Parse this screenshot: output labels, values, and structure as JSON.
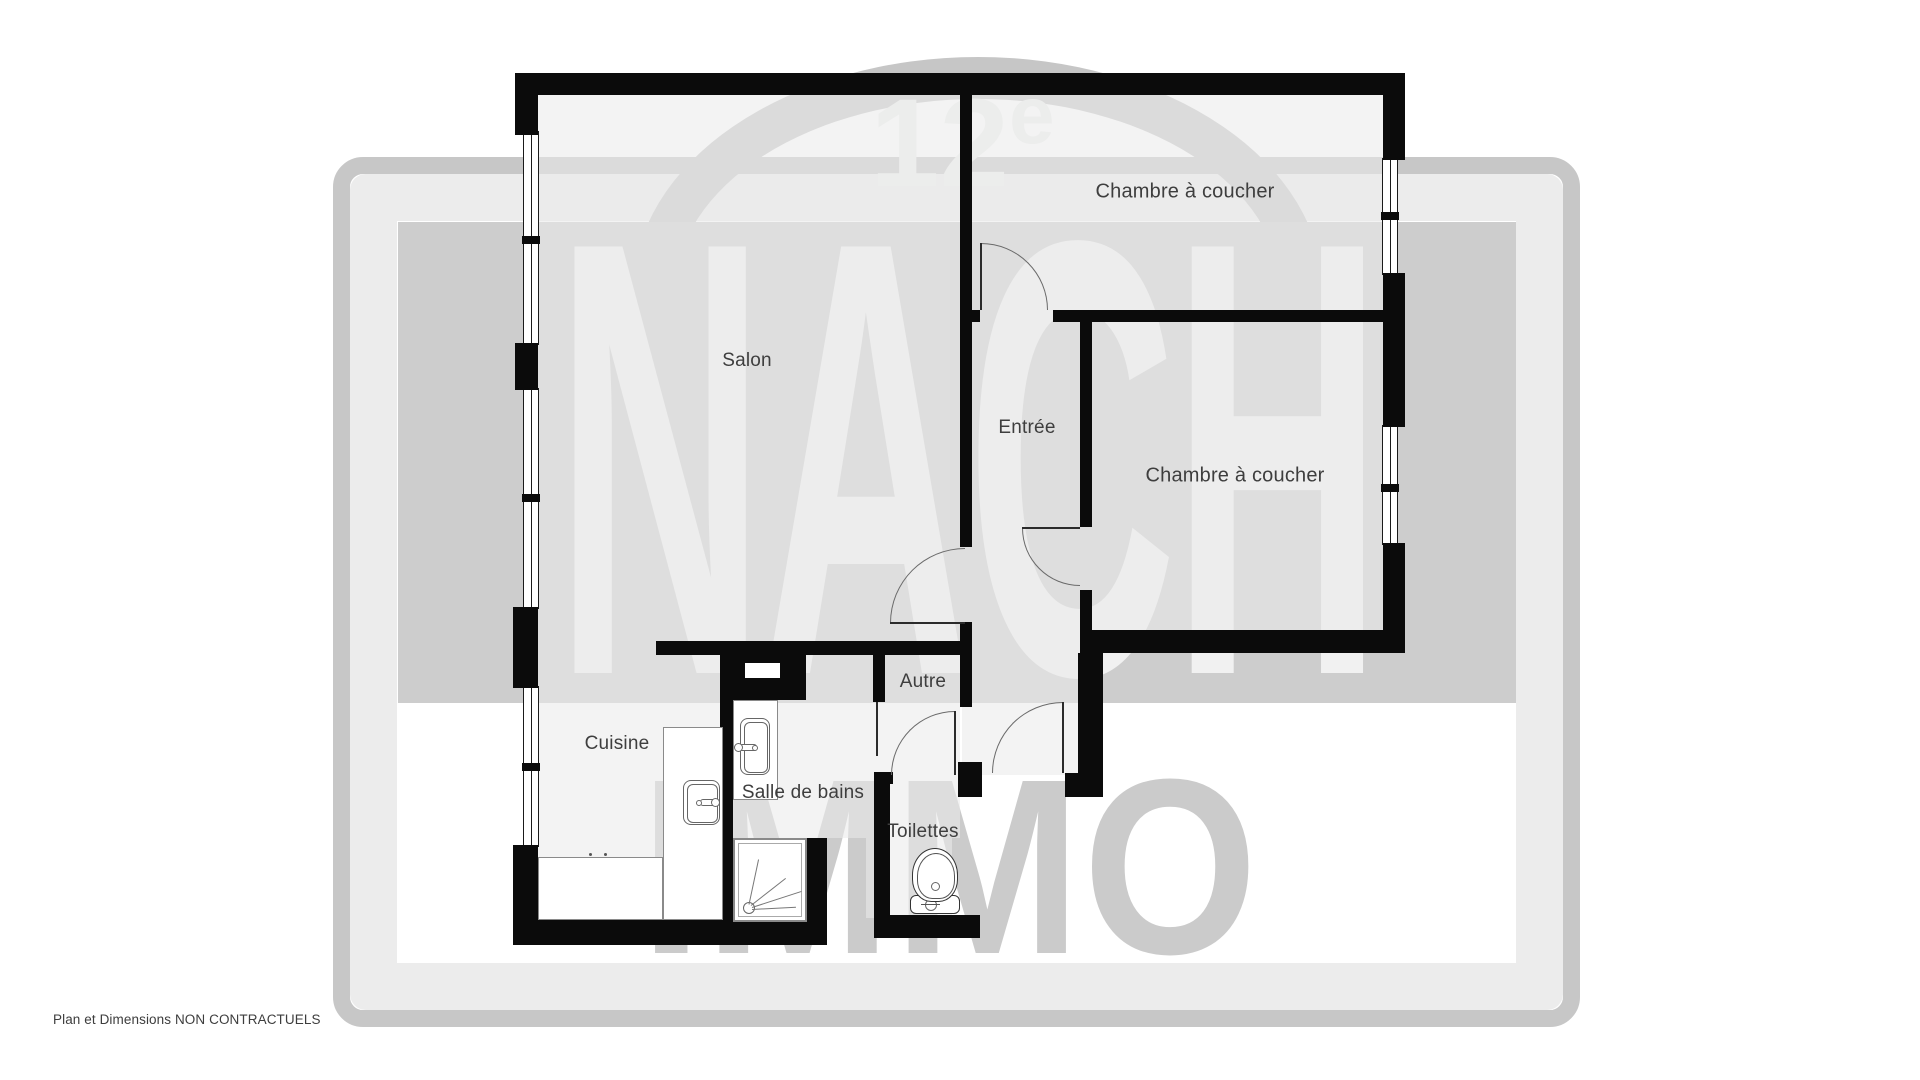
{
  "plan": {
    "rooms": [
      {
        "id": "chambre-1",
        "label": "Chambre à coucher"
      },
      {
        "id": "chambre-2",
        "label": "Chambre à coucher"
      },
      {
        "id": "salon",
        "label": "Salon"
      },
      {
        "id": "entree",
        "label": "Entrée"
      },
      {
        "id": "cuisine",
        "label": "Cuisine"
      },
      {
        "id": "salle-de-bains",
        "label": "Salle de bains"
      },
      {
        "id": "toilettes",
        "label": "Toilettes"
      },
      {
        "id": "autre",
        "label": "Autre"
      }
    ],
    "disclaimer": "Plan et Dimensions NON CONTRACTUELS"
  },
  "watermark": {
    "brand_top": "NACH",
    "brand_bottom": "IMMO",
    "arrondissement_number": "12",
    "arrondissement_suffix": "e"
  },
  "colors": {
    "wall": "#0b0b0b",
    "label_text": "#3e3e3e",
    "watermark_badge": "#cdcdcd",
    "watermark_letters": "#f1f1f1",
    "watermark_frame": "#c7c7c7",
    "page_background": "#ffffff"
  }
}
